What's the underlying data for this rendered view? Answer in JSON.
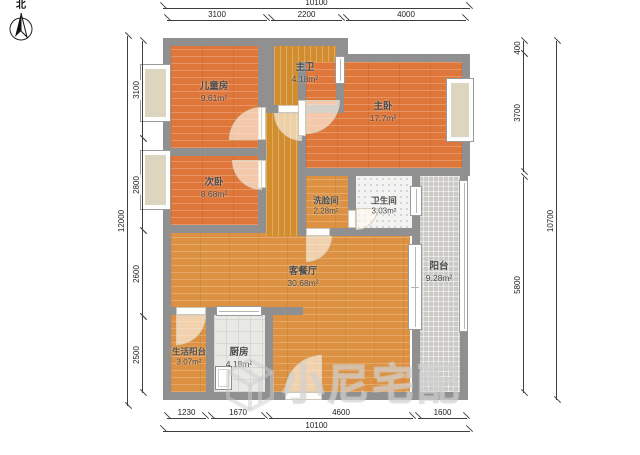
{
  "north": {
    "label": "北"
  },
  "rooms": [
    {
      "name": "儿童房",
      "area": "9.61m²"
    },
    {
      "name": "主卫",
      "area": "4.18m²"
    },
    {
      "name": "主卧",
      "area": "17.7m²"
    },
    {
      "name": "次卧",
      "area": "8.68m²"
    },
    {
      "name": "洗脸间",
      "area": "2.28m²"
    },
    {
      "name": "卫生间",
      "area": "3.03m²"
    },
    {
      "name": "客餐厅",
      "area": "30.68m²"
    },
    {
      "name": "阳台",
      "area": "9.28m²"
    },
    {
      "name": "生活阳台",
      "area": "3.07m²"
    },
    {
      "name": "厨房",
      "area": "4.18m²"
    }
  ],
  "dimensions": {
    "top": {
      "total": "10100",
      "segments": [
        "3100",
        "2200",
        "4000"
      ]
    },
    "bottom": {
      "total": "10100",
      "segments": [
        "1230",
        "1670",
        "4600",
        "1600"
      ]
    },
    "left": {
      "total": "12000",
      "segments": [
        "3100",
        "2800",
        "2600",
        "2500"
      ]
    },
    "right": {
      "total": "10700",
      "segments": [
        "400",
        "3700",
        "5800"
      ]
    }
  },
  "watermark": {
    "text": "小尼宅配"
  },
  "colors": {
    "wood_orange": "#e0773a",
    "wood_gold": "#dd9243",
    "wall_gray": "#909090",
    "balcony_tile": "#cbcac6",
    "window_sill": "#ddd5c0"
  }
}
